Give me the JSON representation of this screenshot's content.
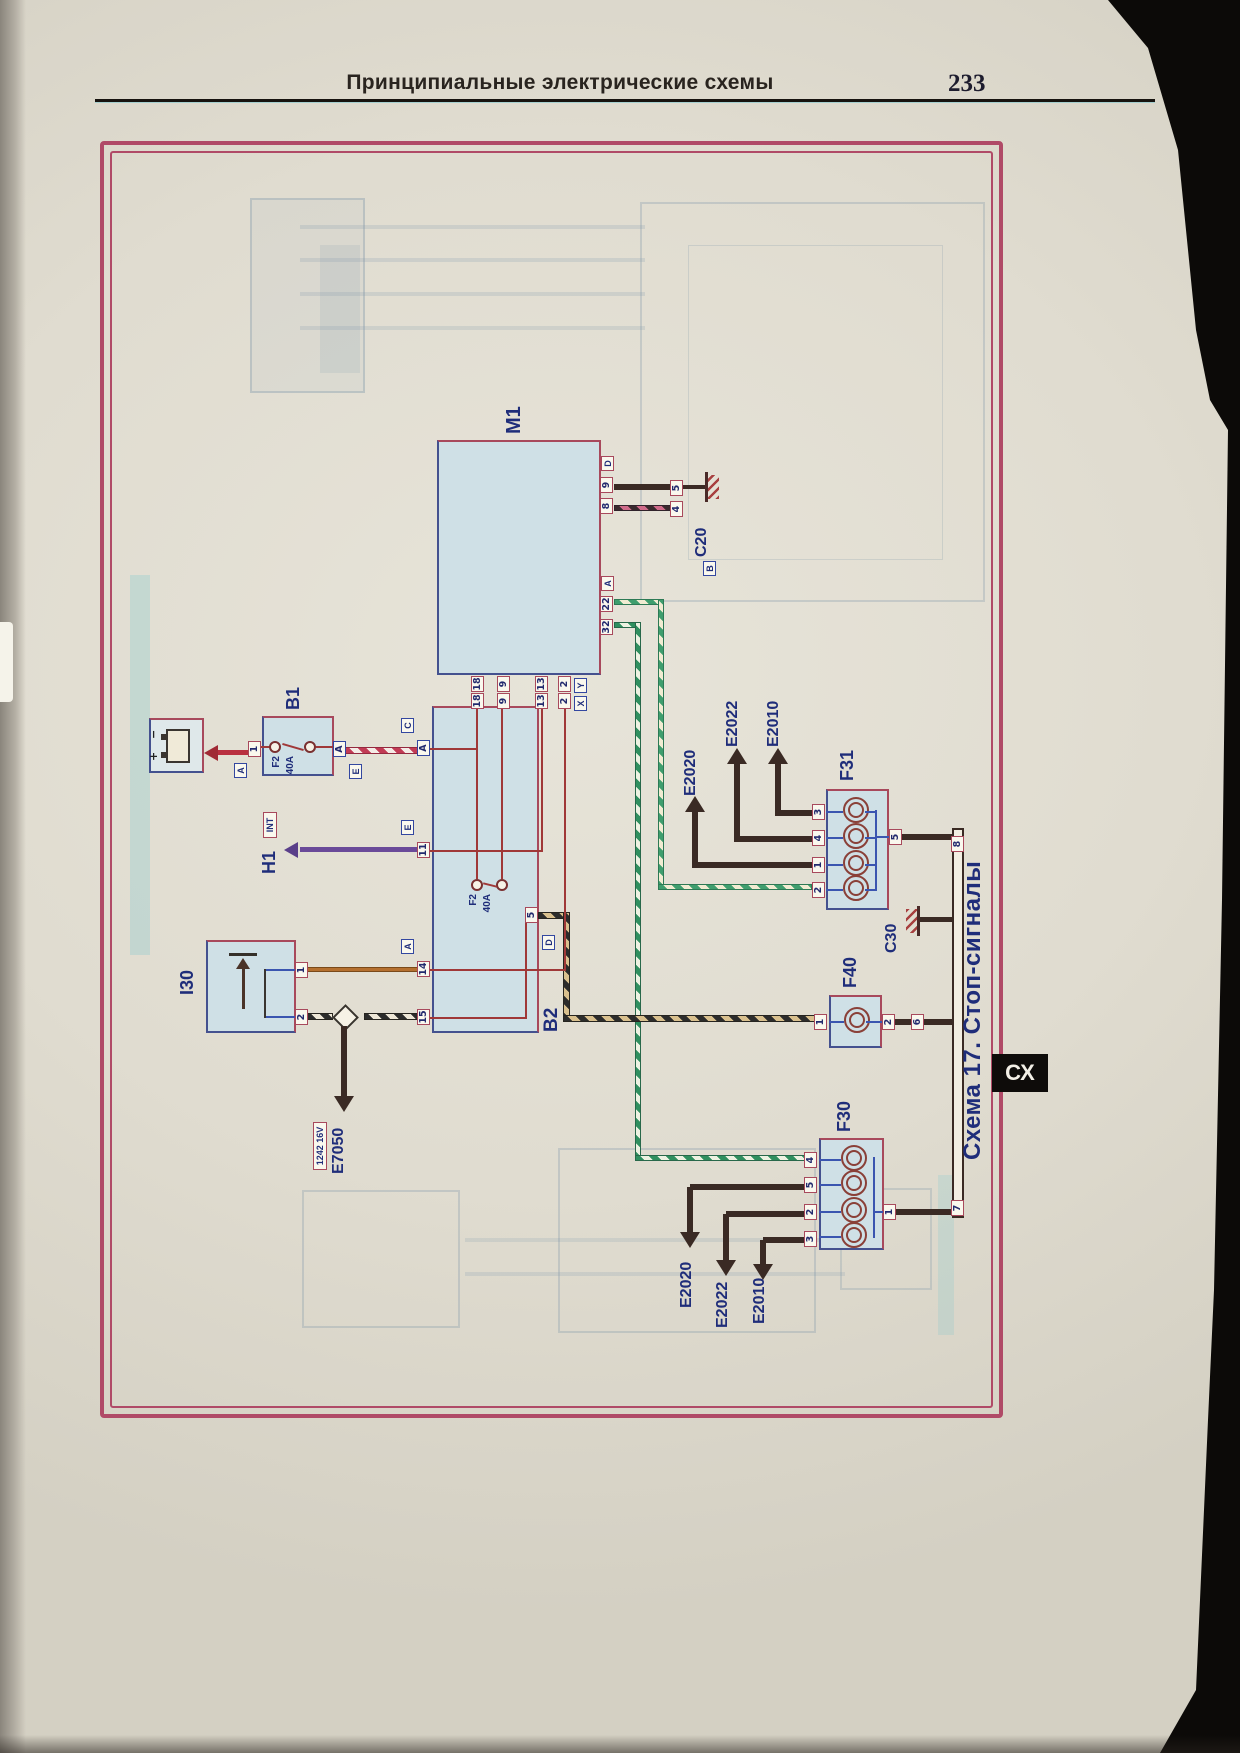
{
  "header": {
    "title": "Принципиальные электрические схемы",
    "page_number": "233"
  },
  "side_tab": {
    "label": "СХ"
  },
  "d": {
    "title": "Схема 17. Стоп-сигналы",
    "m1": {
      "label": "М1",
      "conn_d": "D",
      "p9": "9",
      "p8": "8",
      "conn_a": "A",
      "p22": "22",
      "p32": "32"
    },
    "c20": {
      "label": "С20",
      "part": "B",
      "p5": "5",
      "p4": "4"
    },
    "xy": {
      "x": "X",
      "y": "Y",
      "r18": "18",
      "r9": "9",
      "r13": "13",
      "r2": "2"
    },
    "b2": {
      "label": "В2",
      "fuse": "F2",
      "rating": "40А",
      "pin_a": "A",
      "lbl_c": "C",
      "p11": "11",
      "lbl_e": "E",
      "p14": "14",
      "lbl_a": "A",
      "p15": "15",
      "p5": "5",
      "lbl_d": "D"
    },
    "b1": {
      "label": "В1",
      "fuse": "F2",
      "rating": "40А",
      "p1": "1",
      "lbl_a": "A",
      "pin_a": "A",
      "lbl_e": "E"
    },
    "h1": {
      "label": "Н1",
      "tag": "INT"
    },
    "i30": {
      "label": "I30",
      "p1": "1",
      "p2": "2"
    },
    "e7050": {
      "label": "E7050",
      "engine": "1242 16V"
    },
    "f31": {
      "label": "F31",
      "p3": "3",
      "p4": "4",
      "p1": "1",
      "p2": "2",
      "p5": "5"
    },
    "f40": {
      "label": "F40",
      "p1": "1",
      "p2": "2"
    },
    "f30": {
      "label": "F30",
      "p4": "4",
      "p5": "5",
      "p2": "2",
      "p3": "3",
      "p1": "1"
    },
    "c30": {
      "label": "С30"
    },
    "bar": {
      "p8": "8",
      "p6": "6",
      "p7": "7"
    },
    "gt": {
      "e2020": "E2020",
      "e2022": "E2022",
      "e2010": "E2010"
    },
    "gb": {
      "e2020": "E2020",
      "e2022": "E2022",
      "e2010": "E2010"
    }
  },
  "colors": {
    "frame": "#b04a67",
    "component_fill": "#cfe0e6",
    "navy": "#1f2d7a",
    "dark_wire": "#3a2a24",
    "green_stripe": "#2f8f5f",
    "red_stripe": "#c23b55"
  }
}
